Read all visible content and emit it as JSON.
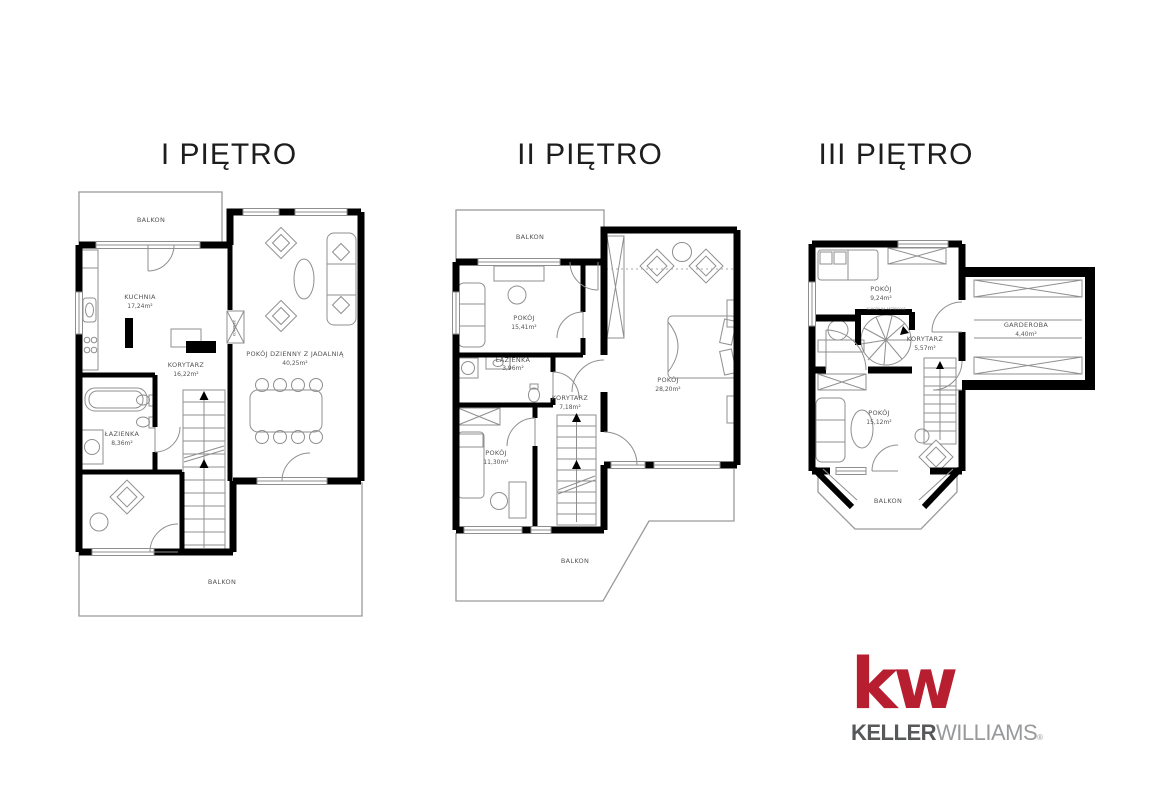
{
  "floor1": {
    "title": "I PIĘTRO",
    "balkon_top": "BALKON",
    "kuchnia": {
      "name": "KUCHNIA",
      "area": "17,24m²"
    },
    "pokoj_dzienny": {
      "name": "POKÓJ DZIENNY Z JADALNIĄ",
      "area": "40,25m²"
    },
    "korytarz": {
      "name": "KORYTARZ",
      "area": "16,22m²"
    },
    "lazienka": {
      "name": "ŁAZIENKA",
      "area": "8,36m²"
    },
    "kominek": "KOMINEK",
    "balkon_bottom": "BALKON"
  },
  "floor2": {
    "title": "II PIĘTRO",
    "balkon_top": "BALKON",
    "pokoj1": {
      "name": "POKÓJ",
      "area": "15,41m²"
    },
    "lazienka": {
      "name": "ŁAZIENKA",
      "area": "3,96m²"
    },
    "korytarz": {
      "name": "KORYTARZ",
      "area": "7,18m²"
    },
    "pokoj2": {
      "name": "POKÓJ",
      "area": "11,30m²"
    },
    "pokoj3": {
      "name": "POKÓJ",
      "area": "28,20m²"
    },
    "balkon_bottom": "BALKON"
  },
  "floor3": {
    "title": "III PIĘTRO",
    "pokoj1": {
      "name": "POKÓJ",
      "area": "9,24m²"
    },
    "korytarz": {
      "name": "KORYTARZ",
      "area": "5,57m²"
    },
    "garderoba": {
      "name": "GARDEROBA",
      "area": "4,40m²"
    },
    "pokoj2": {
      "name": "POKÓJ",
      "area": "15,12m²"
    },
    "schody_note": "SCHODY NA ANTRESOLĘ",
    "balkon": "BALKON"
  },
  "logo": {
    "mark": "kw",
    "brand_bold": "KELLER",
    "brand_light": "WILLIAMS",
    "registered": "®"
  },
  "colors": {
    "kw_red": "#B71F31",
    "keller_gray": "#57585A",
    "williams_gray": "#97999B",
    "walls": "#000000",
    "background": "#FFFFFF"
  }
}
